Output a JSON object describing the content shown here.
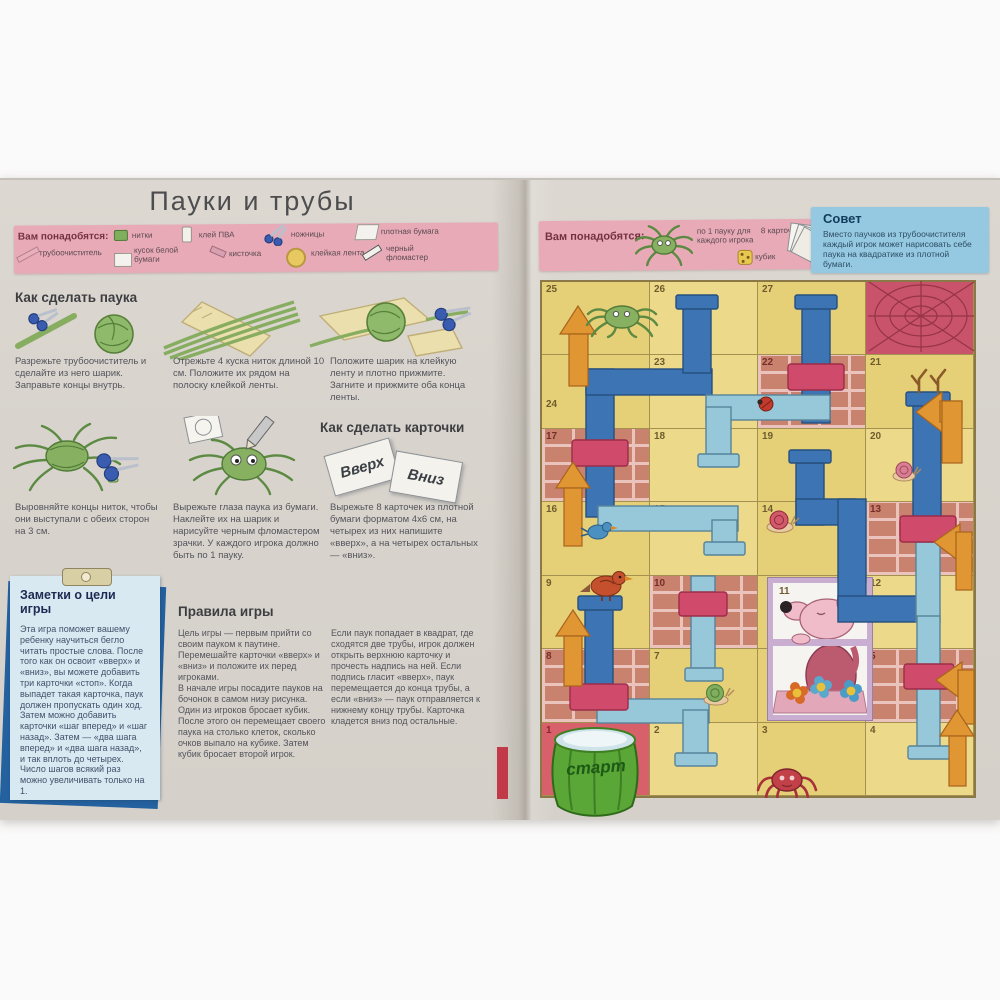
{
  "title": "Пауки и трубы",
  "left": {
    "materials": {
      "label": "Вам понадобятся:",
      "row1": [
        {
          "label": "нитки",
          "icon": "thread-spool"
        },
        {
          "label": "клей ПВА",
          "icon": "glue-bottle"
        },
        {
          "label": "ножницы",
          "icon": "scissors"
        },
        {
          "label": "плотная бумага",
          "icon": "paper-sheet"
        }
      ],
      "row2": [
        {
          "label": "трубоочиститель",
          "icon": "pipe-cleaner"
        },
        {
          "label": "кусок белой бумаги",
          "icon": "paper-piece"
        },
        {
          "label": "кисточка",
          "icon": "brush"
        },
        {
          "label": "клейкая лента",
          "icon": "tape-roll"
        },
        {
          "label": "черный фломастер",
          "icon": "marker"
        }
      ]
    },
    "how_spider": {
      "heading": "Как сделать паука",
      "steps": [
        "Разрежьте трубоочиститель и сделайте из него шарик. Заправьте концы внутрь.",
        "Отрежьте 4 куска ниток длиной 10 см. Положите их рядом на полоску клейкой ленты.",
        "Положите шарик на клейкую ленту и плотно прижмите. Загните и прижмите оба конца ленты.",
        "Выровняйте концы ниток, чтобы они выступали с обеих сторон на 3 см.",
        "Вырежьте глаза паука из бумаги. Наклейте их на шарик и нарисуйте черным фломастером зрачки. У каждого игрока должно быть по 1 пауку."
      ]
    },
    "how_cards": {
      "heading": "Как сделать карточки",
      "card_up": "Вверх",
      "card_down": "Вниз",
      "text": "Вырежьте 8 карточек из плотной бумаги форматом 4х6 см, на четырех из них напишите «вверх», а на четырех остальных — «вниз»."
    },
    "note": {
      "heading": "Заметки о цели игры",
      "body": "Эта игра поможет вашему ребенку научиться бегло читать простые слова. После того как он освоит «вверх» и «вниз», вы можете добавить три карточки «стоп». Когда выпадет такая карточка, паук должен пропускать один ход. Затем можно добавить карточки «шаг вперед» и «шаг назад». Затем — «два шага вперед» и «два шага назад», и так вплоть до четырех. Число шагов всякий раз можно увеличивать только на 1."
    },
    "rules": {
      "heading": "Правила игры",
      "col1": "Цель игры — первым прийти со своим пауком к паутине.\nПеремешайте карточки «вверх» и «вниз» и положите их перед игроками.\nВ начале игры посадите пауков на бочонок в самом низу рисунка.\nОдин из игроков бросает кубик. После этого он перемещает своего паука на столько клеток, сколько очков выпало на кубике. Затем кубик бросает второй игрок.",
      "col2": "Если паук попадает в квадрат, где сходятся две трубы, игрок должен открыть верхнюю карточку и прочесть надпись на ней. Если подпись гласит «вверх», паук перемещается до конца трубы, а если «вниз» — паук отправляется к нижнему концу трубы. Карточка кладется вниз под остальные."
    }
  },
  "right": {
    "materials": {
      "label": "Вам понадобятся:",
      "items": [
        {
          "label": "по 1 пауку для каждого игрока",
          "icon": "spider"
        },
        {
          "label": "8 карточек",
          "icon": "cards-stack"
        },
        {
          "label": "кубик",
          "icon": "dice"
        }
      ]
    },
    "tip": {
      "heading": "Совет",
      "body": "Вместо паучков из трубоочистителя каждый игрок может нарисовать себе паука на квадратике из плотной бумаги."
    },
    "board": {
      "start_label": "старт",
      "cells": [
        {
          "n": "25"
        },
        {
          "n": "26"
        },
        {
          "n": "27"
        },
        {
          "n": ""
        },
        {
          "n": "24"
        },
        {
          "n": "23"
        },
        {
          "n": "22"
        },
        {
          "n": "21"
        },
        {
          "n": "17"
        },
        {
          "n": "18"
        },
        {
          "n": "19"
        },
        {
          "n": "20"
        },
        {
          "n": "16"
        },
        {
          "n": "15"
        },
        {
          "n": "14"
        },
        {
          "n": "13"
        },
        {
          "n": "9"
        },
        {
          "n": "10"
        },
        {
          "n": "11"
        },
        {
          "n": "12"
        },
        {
          "n": "8"
        },
        {
          "n": "7"
        },
        {
          "n": ""
        },
        {
          "n": "5"
        },
        {
          "n": "1"
        },
        {
          "n": "2"
        },
        {
          "n": "3"
        },
        {
          "n": "4"
        }
      ],
      "features": [
        "spider-web-goal",
        "green-spider",
        "ladybug",
        "snails",
        "robin",
        "blue-bird",
        "mouse-in-window",
        "flowers",
        "antlers",
        "start-barrel",
        "red-spider",
        "orange-arrows",
        "blue-pipes"
      ]
    }
  },
  "colors": {
    "strip_pink": "#e9aab8",
    "tip_blue": "#95c9e2",
    "board_yellow": "#e6d077",
    "web_red": "#c8536a",
    "pipe_dark": "#3d74b4",
    "pipe_light": "#96c8da",
    "collar_red": "#d04b6b",
    "arrow_orange": "#e09632",
    "note_blue": "#24619f",
    "barrel_green": "#5aa636"
  }
}
